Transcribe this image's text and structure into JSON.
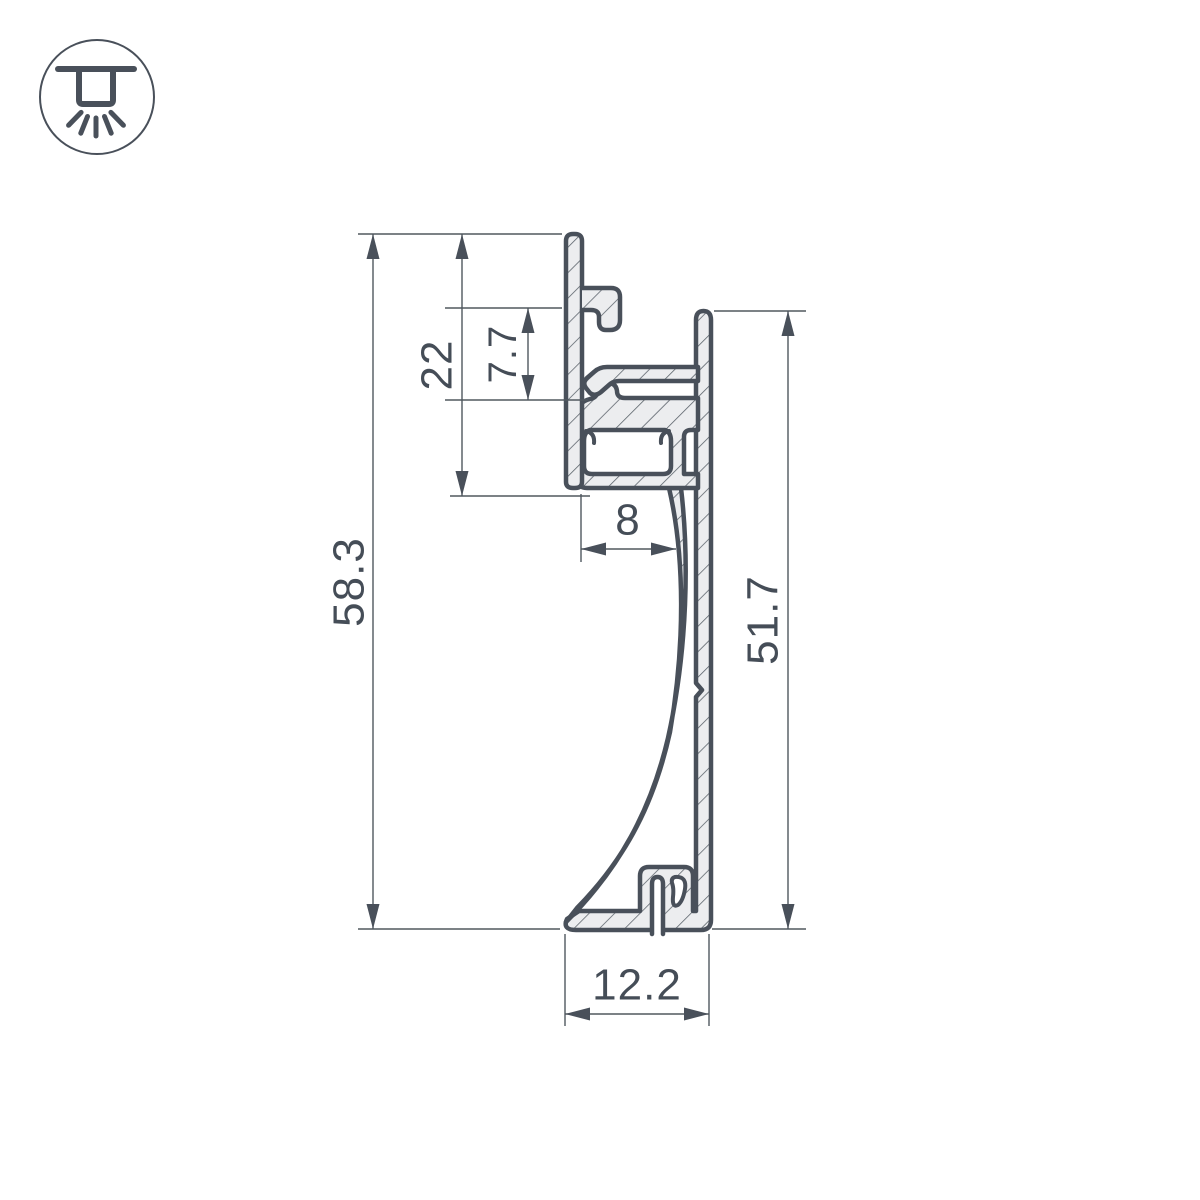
{
  "icon": {
    "name": "recessed-downlight-icon",
    "description": "ceiling recessed light shining downward"
  },
  "drawing": {
    "title": "aluminium-led-plinth-profile-cross-section",
    "dimensions": {
      "total_height": "58.3",
      "flange_height": "22",
      "hook_offset": "7.7",
      "led_channel_width": "8",
      "body_height": "51.7",
      "base_width": "12.2"
    }
  },
  "colors": {
    "outline": "#49505A",
    "material_fill": "#ECEDEF",
    "hatch_line": "#565E66",
    "dimension_line": "#50585F",
    "text": "#454D57",
    "background": "#FFFFFF"
  }
}
